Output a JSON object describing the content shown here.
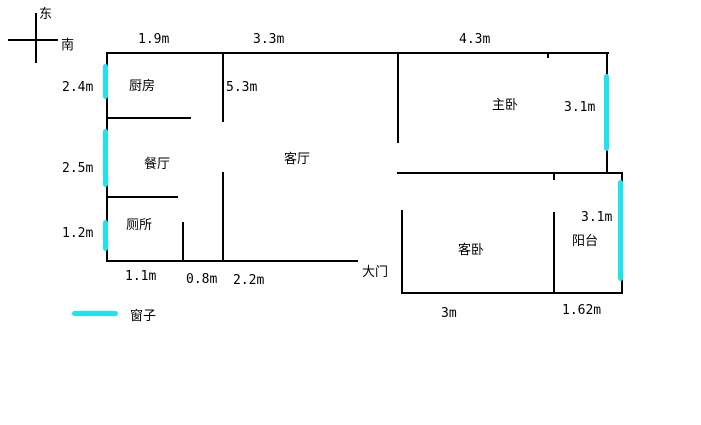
{
  "title": "apartment floor plan sketch",
  "compass": {
    "east": "东",
    "south": "南"
  },
  "rooms": {
    "kitchen": "厨房",
    "dining": "餐厅",
    "living": "客厅",
    "toilet": "厕所",
    "master_bedroom": "主卧",
    "guest_bedroom": "客卧",
    "balcony": "阳台"
  },
  "door": {
    "label": "大门"
  },
  "legend": {
    "window_label": "窗子"
  },
  "dimensions": {
    "top": {
      "kitchen_width": "1.9m",
      "living_width": "3.3m",
      "master_width": "4.3m"
    },
    "left": {
      "kitchen_height": "2.4m",
      "dining_height": "2.5m",
      "toilet_height": "1.2m"
    },
    "inner": {
      "living_height": "5.3m"
    },
    "right": {
      "master_height": "3.1m",
      "balcony_height": "3.1m"
    },
    "bottom": {
      "toilet_width": "1.1m",
      "toilet_door_width": "0.8m",
      "living_bottom_width": "2.2m",
      "guest_width": "3m",
      "balcony_width": "1.62m"
    }
  },
  "colors": {
    "wall": "#000000",
    "window": "#1ee3f0",
    "background": "#ffffff"
  }
}
